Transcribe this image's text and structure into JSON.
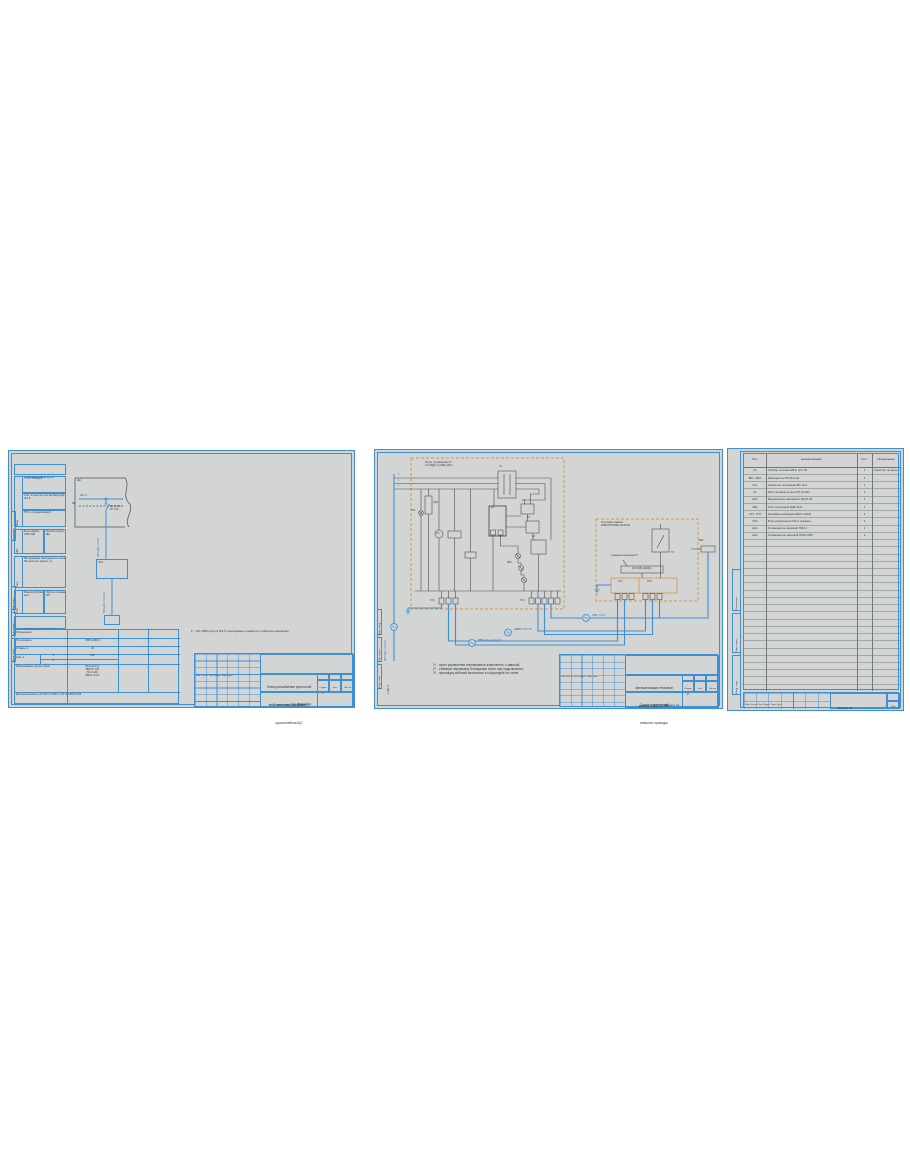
{
  "colors": {
    "sheet_bg": "#d3d4d4",
    "frame_blue": "#3f8fd4",
    "wire_dark": "#4b4e52",
    "equipment_orange": "#dd9440",
    "cable_blue": "#3f8fd4"
  },
  "tbcommon": {
    "micro": "Изм. Кол.уч. Лист №док. Подп. Дата",
    "stage_label": "Стадия",
    "sheet_label": "Лист",
    "sheets_label": "Листов"
  },
  "s1": {
    "side": [
      "Согласовано",
      "Взам. инв. №",
      "Подп. и дата",
      "Инв. № подл."
    ],
    "stack": {
      "header": "Наименование щита",
      "r1l": "Ввод",
      "r1a": "ТП-1 с.1 ввод А",
      "r1b": "Учёт эл.энергии счётчик Меркурий 201.5",
      "r1c": "ТП-1 с.2 резерв ввод Б",
      "r2l": "Щит",
      "r2a": "Реле напряж. УЗМ-51М",
      "r2b": "Розетки группы ЩС",
      "r3l": "Сеть",
      "r3a": "РЕ-проводник присоединить к шине РЕ щита (см. примеч. 1)",
      "r4l": "Учёт",
      "r4a": "Розетки рабочих мест",
      "r4b": "Прочие силовые ЭП"
    },
    "diag": {
      "corner": "ЩС",
      "bus": "ЩС 3",
      "pe": "PE",
      "brk": "ВА 47-29\n1Р С25",
      "cab1": "ВВГнг(А)-LS 5х6",
      "box": "ЯУ1",
      "cab2": "ВВГнг(А)-LS 3х2,5"
    },
    "tbl": {
      "header": "Распределительная сеть",
      "r1l": "Обозначение",
      "r1v": "-",
      "r2l": "Тип аппарата",
      "r2v": "ПВР 2/25/23",
      "r3l": "Уставка, А",
      "r3v": "25",
      "r4l": "Iном, А",
      "r4a": "1",
      "r4b": "2",
      "r4va": "25А",
      "r4vb": "-",
      "r5l": "Наименование группы, Рном",
      "r5v": "Вентилятор\nВЕНТС 150\nN=1,5 кВт\nВВГнг 3х2,5",
      "r6": "Монтаж выполнить по ГОСТ Р 50571, СП 76.13330.2016"
    },
    "note": "1* - ЩС, ВВГнг(А)-LS 3х2,5 прокладывать совместно с кабелем освещения.",
    "tb": {
      "title1": "Электроснабжение приточной\nвент. системы ПВ1 (021/19)",
      "title2": "Схема электрическая\nоднолинейная ЩС",
      "stage": "Р"
    },
    "format": "Формат А3"
  },
  "s2": {
    "side": [
      "Взам. инв. №",
      "Подп. и дата",
      "Инв. № подл."
    ],
    "busnums": [
      "1",
      "2",
      "3"
    ],
    "box1": "Пульт управления 1*\nтип ПДУ-3 (СВН-302)",
    "box2": "Тепловая завеса\nКЭВ-6П1152Е (021/19)",
    "sym": {
      "t1": "Т1",
      "qf": "QF1",
      "hl": "HL1",
      "pv": "PV",
      "a1": "А1",
      "k1": "К1",
      "k2": "К2",
      "k3": "К3",
      "sb": "SB1",
      "xt1": "ХТ1",
      "xt2": "ХТ2",
      "ek": "ЕК1*",
      "tz": "ТЗ",
      "grp1": "ХТ1",
      "grp2": "НТС",
      "jumper": "съёмная перемычка 2*",
      "block": "БУ-КЭВ (СЕ291)"
    },
    "cables": {
      "riser": "ВВГнг(А)-LS 3х1,5",
      "dest": "к ЩС 3",
      "runA": "ВВГнг(А)-LS 3х1,5",
      "runB": "ШВВП 2х0,75",
      "runC": "ПВС 7х1,5"
    },
    "notes": [
      "1* - пульт управления поставляется комплектно с завесой;",
      "2* - съёмную перемычку блокировки снять при подключении;",
      "3* - прокладку кабелей выполнить в гофротрубе по стене."
    ],
    "tb": {
      "title1": "Автоматизация тепловой\nзавесы КЭВ (021/19)",
      "title2": "Схема соединений\nвнешних проводок",
      "stage": "Р"
    },
    "format": "Формат А3"
  },
  "s3": {
    "side": [
      "Согласовано",
      "Подп. и дата",
      "Инв. № подл."
    ],
    "head": [
      "Поз.",
      "Наименование",
      "Кол.",
      "Примечание"
    ],
    "rows": [
      [
        "А1",
        "Прибор «Сигнал-20П» исп. 02",
        "1",
        "Смонтир. на щите"
      ],
      [
        "ВК1...ВК4",
        "Извещатель ИП 212-141",
        "4",
        ""
      ],
      [
        "HL1",
        "Указатель положения ВС-10-1",
        "1",
        ""
      ],
      [
        "К1",
        "Реле промежуточное РП-21-003",
        "1",
        ""
      ],
      [
        "QF1",
        "Выключатель автоматич. ВА47-29",
        "1",
        ""
      ],
      [
        "SB1",
        "Пост кнопочный КМЕ 4111",
        "1",
        ""
      ],
      [
        "ХТ1, ХТ2",
        "Клеммник наборный ЗНИ-4 (DIN)",
        "2",
        ""
      ],
      [
        "XS1",
        "Блок управления АЧС-2 «Гранат»",
        "1",
        ""
      ],
      [
        "НА1",
        "Оповещатель звуковой ПКИ-1",
        "1",
        ""
      ],
      [
        "НА2",
        "Оповещатель световой ПКИ-СП12",
        "1",
        ""
      ]
    ],
    "strip": {
      "micro": "Изм. Кол.уч. Лист №док. Подп. Дата",
      "sheet": "Лист"
    },
    "format": "Формат А4"
  }
}
